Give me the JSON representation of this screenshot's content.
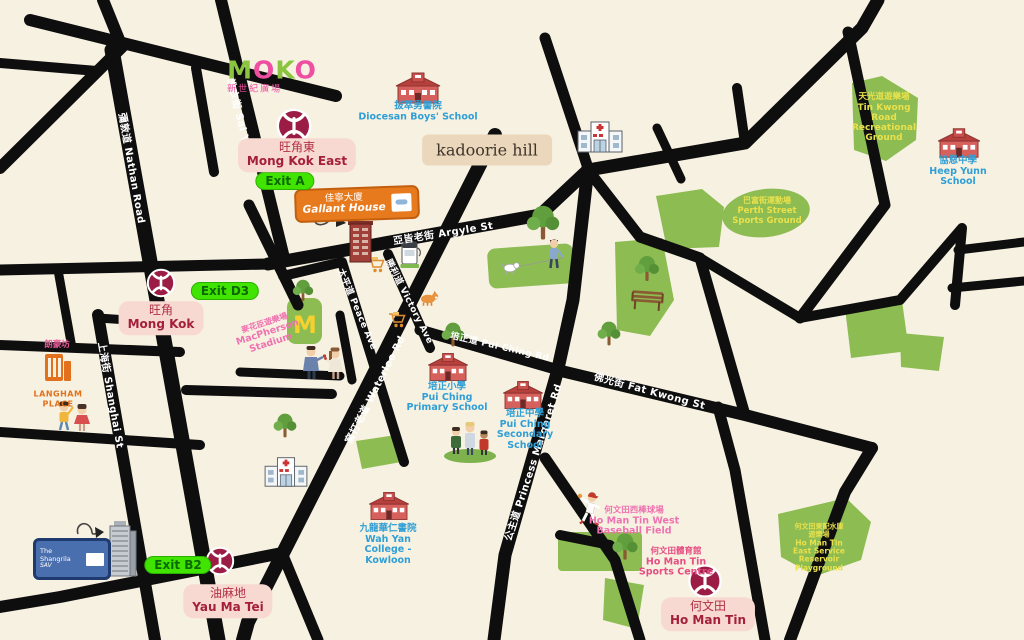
{
  "colors": {
    "background": "#f7f1e1",
    "road": "#0e0e0e",
    "green_area": "#8dbc52",
    "green_area_text": "#e9e14c",
    "mtr_maroon": "#9b1d45",
    "station_pill_bg": "#f8d9d1",
    "exit_pill_bg": "#41e400",
    "school_blue": "#2f9fd6",
    "pink_label": "#ef72b0",
    "orange_brand": "#e87a1e"
  },
  "streets": [
    {
      "id": "nathan-road",
      "label": "彌敦道 Nathan Road"
    },
    {
      "id": "sai-yee-st",
      "label": "洗衣街 Sai Yee St"
    },
    {
      "id": "shanghai-st",
      "label": "上海街 Shanghai St"
    },
    {
      "id": "argyle-st",
      "label": "亞皆老街 Argyle St"
    },
    {
      "id": "waterloo-rd",
      "label": "窩打老道 Waterloo Rd"
    },
    {
      "id": "victory-ave",
      "label": "勝利道 Victory Ave"
    },
    {
      "id": "peace-ave",
      "label": "太平道 Peace Ave"
    },
    {
      "id": "pui-ching-rd",
      "label": "培正道 Pui Ching Rd"
    },
    {
      "id": "princess-margaret-rd",
      "label": "公主道 Princess Margaret Rd"
    },
    {
      "id": "fat-kwong-st",
      "label": "佛光街 Fat Kwong St"
    }
  ],
  "stations": [
    {
      "id": "mong-kok-east",
      "zh": "旺角東",
      "en": "Mong Kok East"
    },
    {
      "id": "mong-kok",
      "zh": "旺角",
      "en": "Mong Kok"
    },
    {
      "id": "yau-ma-tei",
      "zh": "油麻地",
      "en": "Yau Ma Tei"
    },
    {
      "id": "ho-man-tin",
      "zh": "何文田",
      "en": "Ho Man Tin"
    }
  ],
  "exits": [
    {
      "label": "Exit A"
    },
    {
      "label": "Exit D3"
    },
    {
      "label": "Exit B2"
    }
  ],
  "places": {
    "moko": {
      "l1": "M",
      "l2": "O",
      "l3": "K",
      "l4": "O",
      "zh": "新世紀廣場"
    },
    "kadoorie_hill": {
      "en": "kadoorie hill"
    },
    "gallant_house": {
      "zh": "佳寧大廈",
      "en": "Gallant House"
    },
    "diocesan_boys_school": {
      "zh": "拔萃男書院",
      "en": "Diocesan Boys' School"
    },
    "heep_yunn_school": {
      "zh": "協恩中學",
      "en": "Heep Yunn\nSchool"
    },
    "tin_kwong_ground": {
      "zh": "天光道遊樂場",
      "en": "Tin Kwong\nRoad\nRecreational\nGround"
    },
    "perth_street_ground": {
      "zh": "巴富街運動場",
      "en": "Perth Street\nSports Ground"
    },
    "macpherson_stadium": {
      "zh": "麥花臣遊樂場",
      "en": "MacPherson\nStadium",
      "logo": "M"
    },
    "pui_ching_primary": {
      "zh": "培正小學",
      "en": "Pui Ching\nPrimary School"
    },
    "pui_ching_secondary": {
      "zh": "培正中學",
      "en": "Pui Ching\nSecondary\nSchool"
    },
    "wah_yan_college": {
      "zh": "九龍華仁書院",
      "en": "Wah Yan\nCollege -\nKowloon"
    },
    "langham_place": {
      "zh": "朗豪坊",
      "en": "LANGHAM\nPLACE"
    },
    "shangrila": {
      "name": "The\nShangrila",
      "sub": "SAV"
    },
    "hmt_baseball_field": {
      "zh": "何文田西棒球場",
      "en": "Ho Man Tin West\nBaseball Field"
    },
    "hmt_sports_centre": {
      "zh": "何文田體育館",
      "en": "Ho Man Tin\nSports Centre"
    },
    "hmt_reservoir_playground": {
      "zh": "何文田東配水庫\n遊樂場",
      "en": "Ho Man Tin\nEast Service\nReservoir\nPlayground"
    }
  }
}
